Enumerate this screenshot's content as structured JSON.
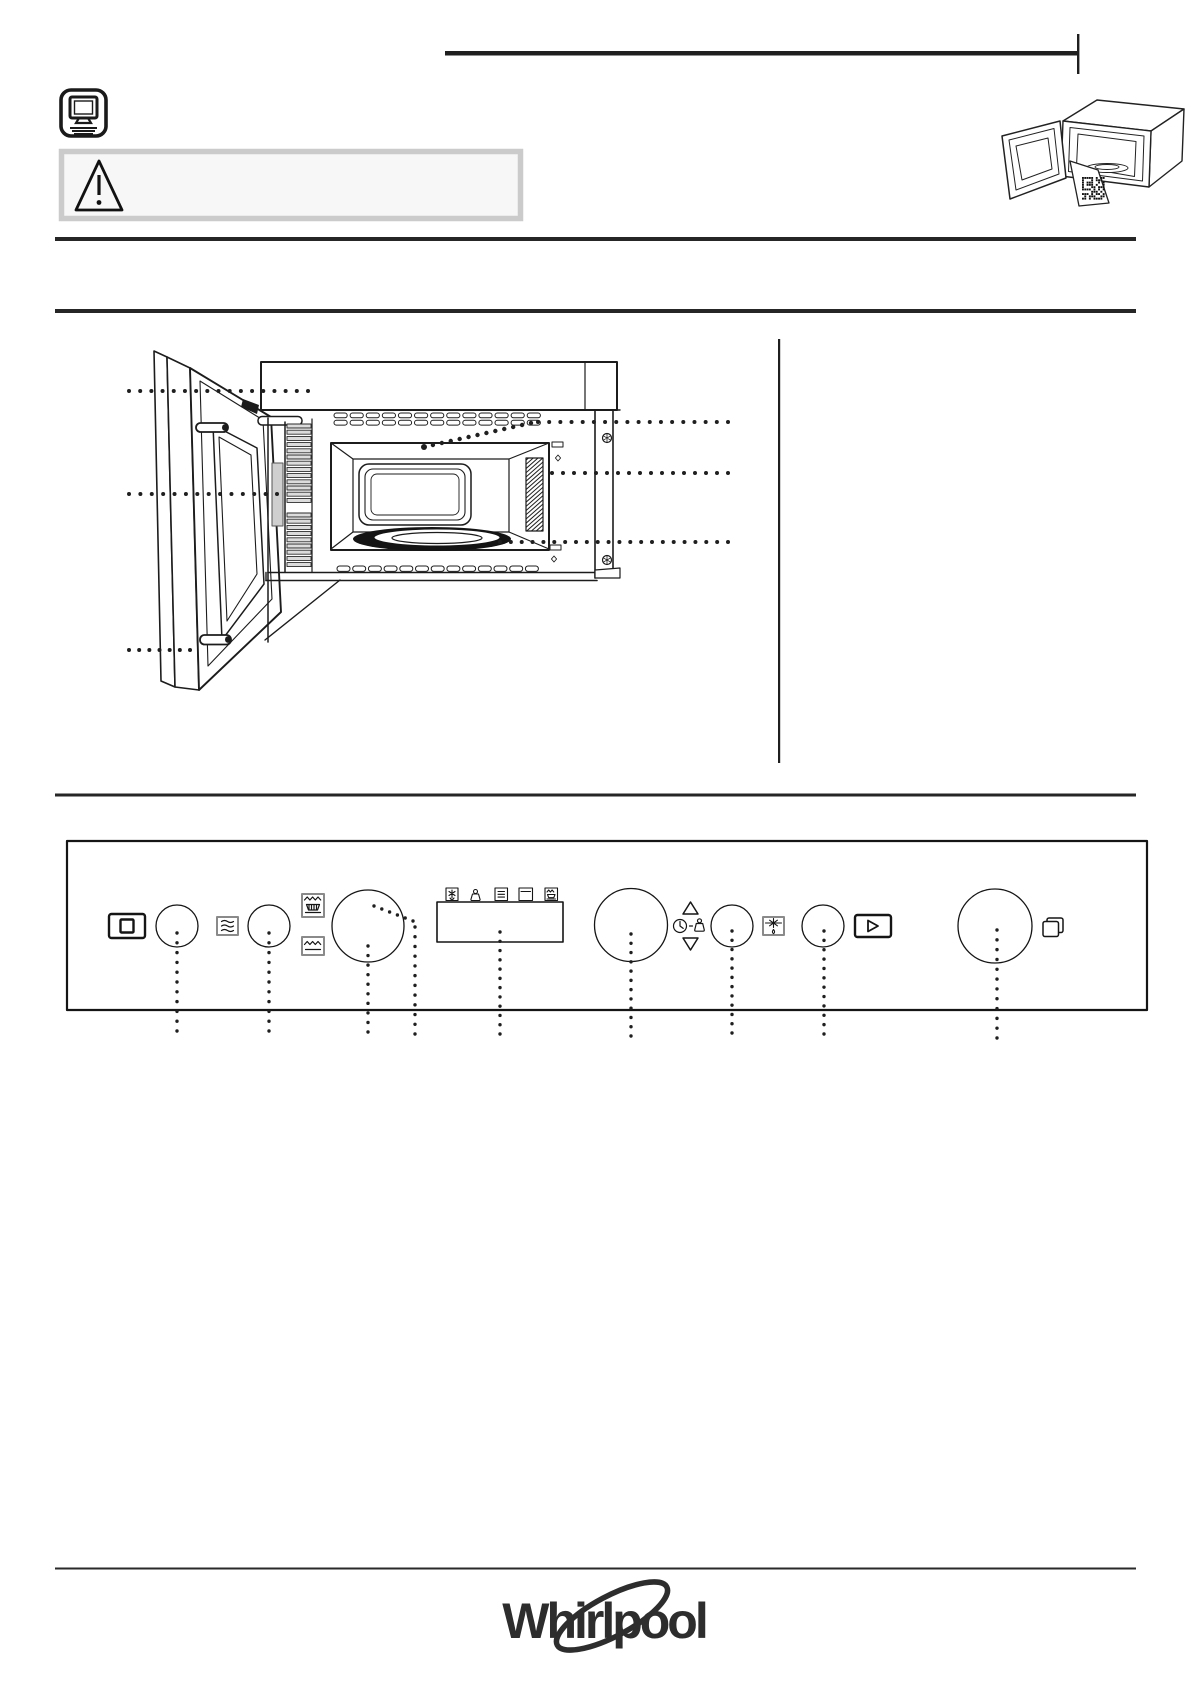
{
  "page": {
    "background": "#ffffff",
    "ink_color": "#1f1f1f",
    "divider_color": "#262626",
    "warning_box": {
      "border_color": "#cbcbcb",
      "fill_color": "#f7f7f7"
    }
  },
  "header": {
    "rule": "horizontal-rule-with-end-tick",
    "manual_icon": "online-manual-monitor-icon",
    "illustration": "microwave-open-door-with-qr-tag",
    "qr": "qr-code"
  },
  "warning": {
    "icon": "warning-triangle-icon"
  },
  "parts_diagram": {
    "illustration": "built-in-microwave-open-door-front-view",
    "callouts": [
      {
        "id": 1,
        "side": "left",
        "target": "top-frame-panel"
      },
      {
        "id": 2,
        "side": "left",
        "target": "door-latch-area"
      },
      {
        "id": 3,
        "side": "left",
        "target": "door-bottom-hinge"
      },
      {
        "id": 4,
        "side": "right",
        "target": "cavity-ceiling-grill"
      },
      {
        "id": 5,
        "side": "right",
        "target": "side-vent"
      },
      {
        "id": 6,
        "side": "right",
        "target": "turntable"
      }
    ]
  },
  "control_panel": {
    "controls": [
      {
        "name": "stop-button",
        "icon": "stop-square-icon"
      },
      {
        "name": "function-knob-1"
      },
      {
        "name": "steam-button",
        "icon": "steam-waves-icon"
      },
      {
        "name": "function-knob-2"
      },
      {
        "name": "grill-steam-combi-button",
        "icon": "grill-dish-icon"
      },
      {
        "name": "grill-button",
        "icon": "grill-element-icon"
      },
      {
        "name": "selector-knob-left"
      },
      {
        "name": "display",
        "indicators": [
          "defrost-box-icon",
          "weight-icon",
          "menu-box-icon",
          "door-box-icon",
          "grill-box-icon"
        ]
      },
      {
        "name": "selector-knob-center"
      },
      {
        "name": "up-arrow-button",
        "icon": "triangle-up-icon"
      },
      {
        "name": "clock-weight-indicator",
        "icons": [
          "clock-icon",
          "weight-icon"
        ]
      },
      {
        "name": "down-arrow-button",
        "icon": "triangle-down-icon"
      },
      {
        "name": "function-knob-3"
      },
      {
        "name": "jet-defrost-button",
        "icon": "snowflake-drop-icon"
      },
      {
        "name": "function-knob-4"
      },
      {
        "name": "start-button",
        "icon": "play-icon"
      },
      {
        "name": "selector-knob-right"
      },
      {
        "name": "door-open-indicator",
        "icon": "open-door-icon"
      }
    ]
  },
  "footer": {
    "logo_text": "Whirlpool",
    "logo_color": "#2d2d2d"
  }
}
